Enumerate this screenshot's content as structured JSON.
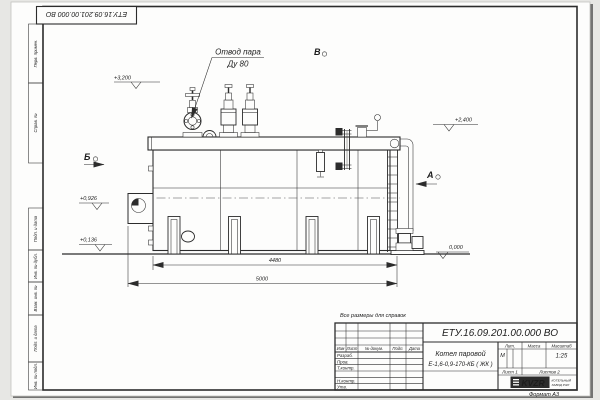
{
  "sheet": {
    "corner_stamp": "ЕТУ.16.09.201.00.000  ВО",
    "margin_labels": [
      "Перв. примен.",
      "Справ. №",
      "Подп. и дата",
      "Инв. № дубл.",
      "Взам. инв. №",
      "Подп. и дата",
      "Инв. № подл."
    ],
    "reference_note": "Все размеры для справок",
    "format_note": "Формат А3"
  },
  "drawing": {
    "callout": {
      "line1": "Отвод пара",
      "line2": "Ду 80"
    },
    "views": {
      "a": "А",
      "b": "Б",
      "v": "В"
    },
    "elevations": {
      "valves_top": "+3,200",
      "drum_right": "+2,400",
      "burner_axis": "+0,926",
      "frame_bottom": "+0,136",
      "ground": "0,000"
    },
    "dimensions": {
      "support_span": "4480",
      "overall_length": "5000"
    }
  },
  "title_block": {
    "doc_number": "ЕТУ.16.09.201.00.000  ВО",
    "product_name": "Котел паровой",
    "product_code": "Е-1,6-0,9-170-КБ ( ЖК )",
    "columns": [
      "Изм",
      "Лист",
      "№ докум.",
      "Подп.",
      "Дата"
    ],
    "rows": [
      "Разраб.",
      "Пров.",
      "Т.контр.",
      "Н.контр.",
      "Утв."
    ],
    "lit_header": "Лит.",
    "mass_header": "Масса",
    "scale_header": "Масштаб",
    "lit_value": "М",
    "scale_value": "1:25",
    "sheet_info": "Лист 1",
    "sheets_info": "Листов 2",
    "logo": "KVZR",
    "company_line1": "КОТЕЛЬНЫЙ",
    "company_line2": "ЗАВОД РЭП"
  }
}
